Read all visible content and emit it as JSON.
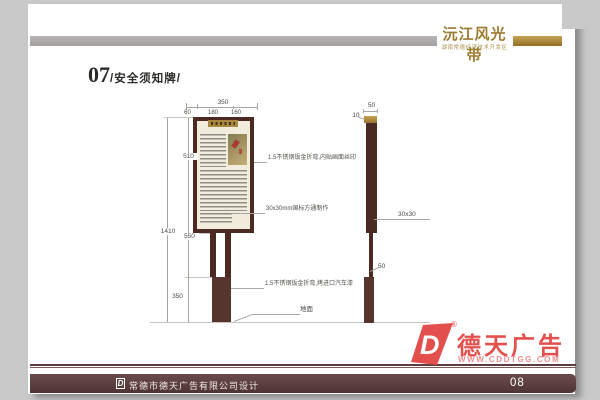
{
  "header": {
    "brand_title": "沅江风光带",
    "brand_subtitle": "湖南常德经济技术开发区"
  },
  "section": {
    "number": "07",
    "title": "/安全须知牌/"
  },
  "front_view": {
    "width_total": "350",
    "width_segments": [
      "60",
      "180",
      "160"
    ],
    "board_height": "510",
    "total_height": "1410",
    "pole_height": "550",
    "base_height": "350",
    "annotations": [
      "1.5不锈钢钣金折弯,内贴画面丝印",
      "30x30mm国标方通制作",
      "1.5不锈钢钣金折弯,烤进口汽车漆"
    ],
    "ground_label": "地面"
  },
  "side_view": {
    "width_top": "50",
    "cap_height": "10",
    "tube_size": "30x30",
    "base_width": "50"
  },
  "watermark": {
    "registered_mark": "®",
    "brand": "德天广告",
    "website": "WWW.CDDTGG.COM",
    "logo_letter": "D"
  },
  "footer": {
    "company": "常德市德天广告有限公司设计",
    "page_number": "08",
    "logo_letter": "D"
  },
  "colors": {
    "accent_gold": "#9d7c31",
    "sign_maroon": "#4b2a24",
    "base_maroon": "#57352f",
    "footer_maroon": "#5c3e3e",
    "watermark_red": "#e24f4c",
    "board_cream": "#f1ecdc",
    "header_gray": "#aeacab"
  }
}
